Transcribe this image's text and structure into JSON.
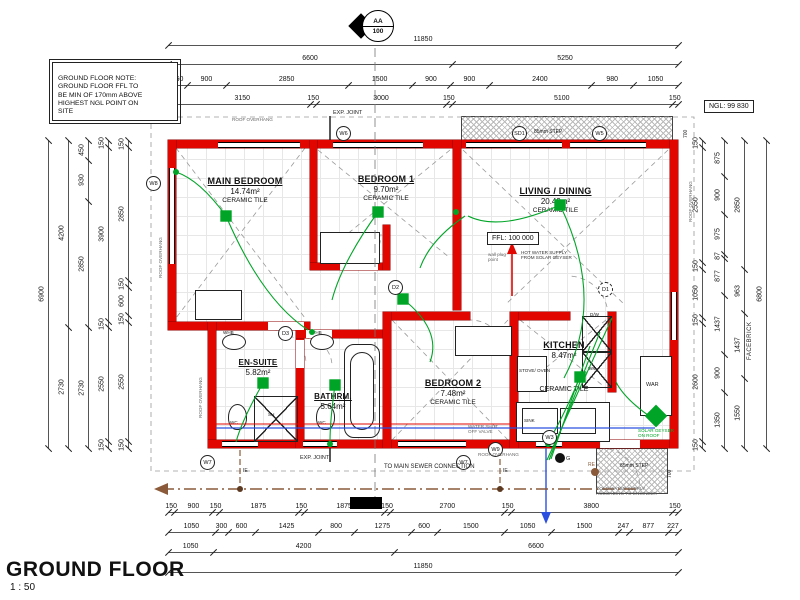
{
  "title": {
    "text": "GROUND FLOOR",
    "scale": "1 : 50"
  },
  "note_box": {
    "text": "GROUND FLOOR NOTE:\nGROUND FLOOR FFL TO\nBE MIN OF 170mm ABOVE\nHIGHEST NGL POINT ON\nSITE"
  },
  "section_marker": {
    "code": "AA",
    "sheet": "100"
  },
  "levels": {
    "ffl": "FFL: 100 000",
    "ngl": "NGL: 99 830"
  },
  "rooms": [
    {
      "name": "MAIN BEDROOM",
      "area": "14.74m²",
      "finish": "CERAMIC TILE"
    },
    {
      "name": "BEDROOM 1",
      "area": "9.70m²",
      "finish": "CERAMIC TILE"
    },
    {
      "name": "LIVING / DINING",
      "area": "20.49m²",
      "finish": "CERAMIC TILE"
    },
    {
      "name": "EN-SUITE",
      "area": "5.82m²",
      "finish": ""
    },
    {
      "name": "BATHRM.",
      "area": "5.64m²",
      "finish": ""
    },
    {
      "name": "BEDROOM 2",
      "area": "7.48m²",
      "finish": "CERAMIC TILE"
    },
    {
      "name": "KITCHEN",
      "area": "8.47m²",
      "finish": "CERAMIC TILE"
    }
  ],
  "markers": [
    "W8",
    "W6",
    "SD1",
    "W5",
    "D1",
    "D2",
    "D3",
    "W7",
    "W7",
    "W9",
    "W3"
  ],
  "fixtures": {
    "whb": "WHB",
    "wc": "WC",
    "shower": "SH",
    "sink": "SINK",
    "stove": "STOVE/\nOVEN",
    "wm": "WM",
    "dw": "D/W",
    "war": "WAR",
    "gully": "G",
    "re": "RE",
    "ie": "IE"
  },
  "annotations": {
    "exp_joint": "EXP. JOINT",
    "roof_overhang": "ROOF OVERHANG",
    "facebrick": "FACEBRICK",
    "sewer": "TO MAIN SEWER CONNECTION",
    "cold_water": "COLD WATER SUPPLY\nACCORDING TO ENGINEER",
    "hot_water": "HOT WATER SUPPLY\nFROM SOLAR GEYSER",
    "solar": "SOLAR GEYSER\nON ROOF",
    "step": "85mm STEP",
    "shutoff": "WATER SHUT\nOFF VALVE",
    "plug_point": "wall plug\npoint"
  },
  "dimensions": {
    "top": [
      [
        11850
      ],
      [
        6600,
        5250
      ],
      [
        450,
        900,
        2850,
        1500,
        900,
        900,
        2400,
        980,
        1050
      ],
      [
        150,
        3150,
        150,
        3000,
        150,
        5100,
        150
      ]
    ],
    "bottom": [
      [
        150,
        900,
        150,
        1875,
        150,
        1875,
        150,
        2700,
        150,
        3800,
        150
      ],
      [
        1050,
        300,
        600,
        1425,
        800,
        1275,
        600,
        1500,
        1050,
        1500,
        247,
        877,
        227
      ],
      [
        1050,
        4200,
        6600
      ],
      [
        11850
      ]
    ],
    "left": [
      [
        6900
      ],
      [
        4200,
        2730
      ],
      [
        450,
        930,
        2850,
        2730
      ],
      [
        150,
        3900,
        150,
        2550,
        150
      ],
      [
        150,
        2850,
        150,
        600,
        150,
        2550,
        150
      ]
    ],
    "right": [
      [
        150,
        2550,
        150,
        1050,
        150,
        2600,
        150
      ],
      [
        875,
        900,
        975,
        87,
        877,
        1437,
        900,
        1350
      ],
      [
        2850,
        963,
        1437,
        1550
      ],
      [
        6800
      ]
    ],
    "step_dims": [
      "700",
      "700"
    ]
  },
  "colors": {
    "wall": "#e10600",
    "electrical": "#00a527",
    "cold_water": "#2b50e0",
    "hot_water": "#e10600",
    "sewer": "#8a5a3a"
  }
}
